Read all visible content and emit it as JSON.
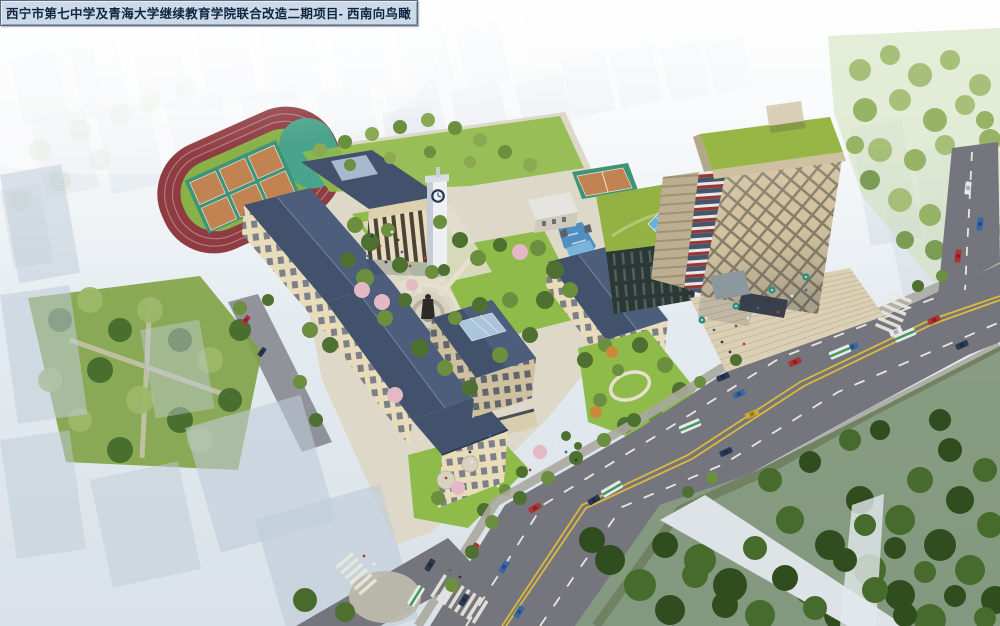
{
  "title_bar": {
    "text": "西宁市第七中学及青海大学继续教育学院联合改造二期项目- 西南向鸟瞰"
  },
  "scene": {
    "name": "aerial-birdseye-architectural-rendering",
    "view_label": "西南向鸟瞰",
    "colors": {
      "fog_top": "#f3f6f8",
      "fog_mid": "#e4ebf0",
      "fog_low": "#dbe4ea",
      "ghost_blue": "#c0ccd8",
      "ghost_white": "#e2e8ec",
      "haze_tree": "#bac9ad",
      "track_red": "#8e3c42",
      "lane_line": "#c89298",
      "infield_green": "#88b148",
      "court_orange": "#c28352",
      "court_teal": "#3f9478",
      "end_teal": "#4aa38c",
      "roof_slate": "#42526c",
      "roof_light": "#55678336",
      "roof_ridge": "#6c7d99",
      "skylight_blue": "#aac4da",
      "facade_cream": "#e9dcba",
      "facade_shade": "#cfc0a0",
      "window_dark": "#676c78",
      "lawn_green": "#8fbb4a",
      "path_beige": "#e6e0cf",
      "ground_base": "#ded8c8",
      "plaza_light": "#e4decf",
      "tree_green": "#6b8f3f",
      "tree_dark": "#4e7030",
      "tree_light": "#8aa952",
      "forest_dark": "#2f4d1e",
      "forest_mid": "#466b2c",
      "park_tree": "#9cb769",
      "blossom_pink": "#e5b8c6",
      "autumn_orange": "#c98a3a",
      "road_gray": "#75757d",
      "yellow_line": "#d9ba3e",
      "marking_white": "#e9e7dc",
      "sidewalk": "#aaa9a0",
      "corner_plaza": "#bdb9ad",
      "tower_beige": "#d5c5a1",
      "tower_grid": "#857c66",
      "tower_side": "#bcae92",
      "tower_roof_green": "#98b646",
      "corner_red": "#9a3530",
      "corner_white": "#e8e8e8",
      "corner_glass": "#45566a",
      "podium_dark": "#2c3836",
      "glass_blue": "#6ab0dd",
      "stairs_beige": "#dbd0b6",
      "strip_white": "#dde3e6",
      "water_blue": "#4f8fc0",
      "statue_dark": "#2e2a26",
      "clock_tower_white": "#eef0f3",
      "clock_face_navy": "#273450",
      "car_red": "#b03232",
      "car_blue": "#3868a8",
      "car_navy": "#2a3a55",
      "car_white": "#e6e8ea",
      "car_yellow": "#c8a832",
      "bus_green": "#3f9a58",
      "title_bg": "#ccd9e9",
      "title_text": "#10233f",
      "title_border": "#5c6b80"
    }
  }
}
